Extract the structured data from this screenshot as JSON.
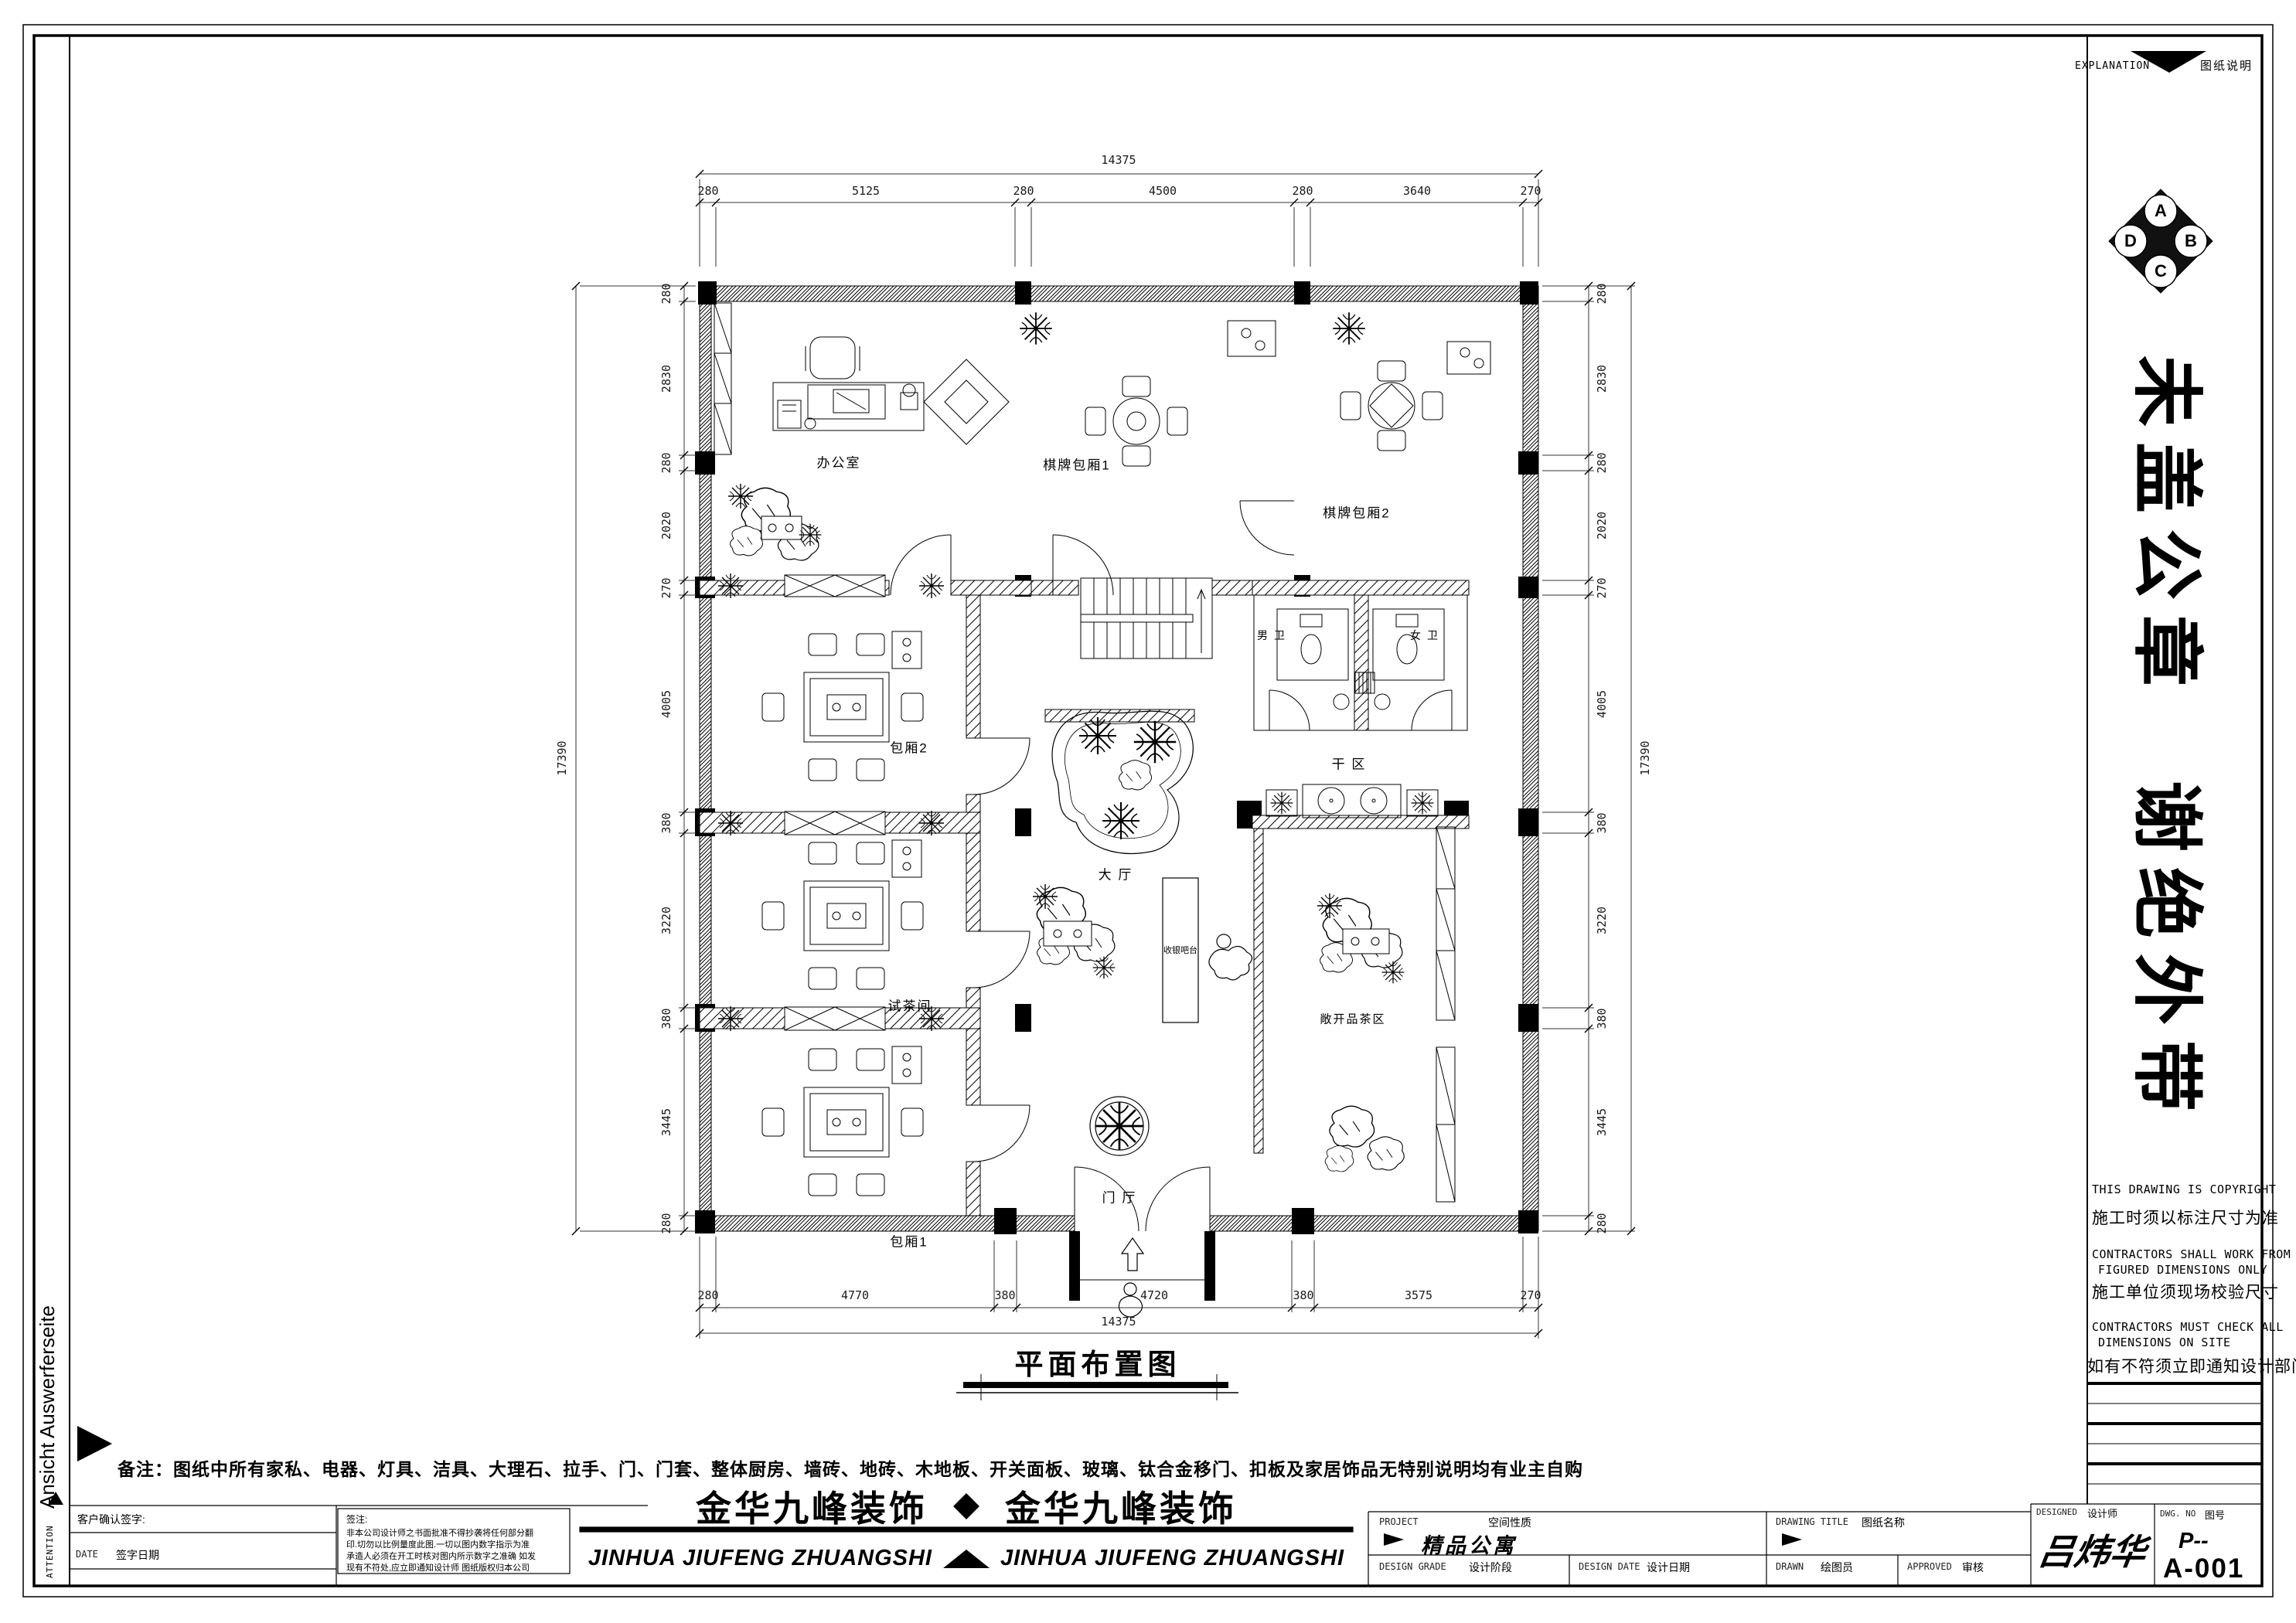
{
  "frame": {
    "left_vertical_text": "Ansicht Auswerferseite",
    "attention": "ATTENTION"
  },
  "explanation": {
    "en": "EXPLANATION",
    "zh": "图纸说明"
  },
  "compass": {
    "a": "A",
    "b": "B",
    "c": "C",
    "d": "D"
  },
  "stamp": {
    "group1": [
      "未",
      "盖",
      "公",
      "章"
    ],
    "group2": [
      "谢",
      "绝",
      "外",
      "带"
    ]
  },
  "notices": {
    "l1en": "THIS DRAWING IS COPYRIGHT",
    "l1zh": "施工时须以标注尺寸为准",
    "l2en1": "CONTRACTORS SHALL WORK FROM",
    "l2en2": "FIGURED DIMENSIONS ONLY",
    "l2zh": "施工单位须现场校验尺寸",
    "l3en1": "CONTRACTORS MUST CHECK ALL",
    "l3en2": "DIMENSIONS ON SITE",
    "l3zh": "如有不符须立即通知设计部门"
  },
  "plan": {
    "title": "平面布置图",
    "rooms": {
      "office": "办公室",
      "mahjong1": "棋牌包厢1",
      "mahjong2": "棋牌包厢2",
      "male_wc": "男 卫",
      "female_wc": "女 卫",
      "box2": "包厢2",
      "tea_room": "试茶间",
      "box1": "包厢1",
      "hall": "大 厅",
      "cashier": "收银吧台",
      "dry_area": "干 区",
      "open_tea": "敞开品茶区",
      "foyer": "门 厅"
    },
    "dims": {
      "top": {
        "total": "14375",
        "segs": [
          "280",
          "5125",
          "280",
          "4500",
          "280",
          "3640",
          "270"
        ]
      },
      "bottom": {
        "total": "14375",
        "segs": [
          "280",
          "4770",
          "380",
          "4720",
          "380",
          "3575",
          "270"
        ]
      },
      "left": {
        "total": "17390",
        "segs": [
          "280",
          "2830",
          "280",
          "2020",
          "270",
          "4005",
          "380",
          "3220",
          "380",
          "3445",
          "280"
        ]
      },
      "right": {
        "total": "17390",
        "segs": [
          "280",
          "2830",
          "280",
          "2020",
          "270",
          "4005",
          "380",
          "3220",
          "380",
          "3445",
          "280"
        ]
      }
    }
  },
  "note_line": "备注：图纸中所有家私、电器、灯具、洁具、大理石、拉手、门、门套、整体厨房、墙砖、地砖、木地板、开关面板、玻璃、钛合金移门、扣板及家居饰品无特别说明均有业主自购",
  "company": {
    "zh": "金华九峰装饰",
    "en": "JINHUA JIUFENG ZHUANGSHI"
  },
  "title_block": {
    "client_sign": "客户确认签字:",
    "date_en": "DATE",
    "date_zh": "签字日期",
    "remark_title": "签注:",
    "remark_lines": [
      "非本公司设计师之书面批准不得抄袭将任何部分翻",
      "印.切勿以比例量度此图.一切以图内数字指示为准",
      "承造人必须在开工时核对图内所示数字之准确 如发",
      "现有不符处,应立即通知设计师 图纸版权归本公司"
    ],
    "project_en": "PROJECT",
    "project_zh": "空间性质",
    "project_value": "精品公寓",
    "design_grade_en": "DESIGN GRADE",
    "design_grade_zh": "设计阶段",
    "design_date_en": "DESIGN DATE",
    "design_date_zh": "设计日期",
    "drawing_title_en": "DRAWING TITLE",
    "drawing_title_zh": "图纸名称",
    "drawn_en": "DRAWN",
    "drawn_zh": "绘图员",
    "approved_en": "APPROVED",
    "approved_zh": "审核",
    "designed_en": "DESIGNED",
    "designed_zh": "设计师",
    "designer_name": "吕炜华",
    "dwg_en": "DWG. NO",
    "dwg_zh": "图号",
    "dwg_value_1": "P--",
    "dwg_value_2": "A-001"
  }
}
